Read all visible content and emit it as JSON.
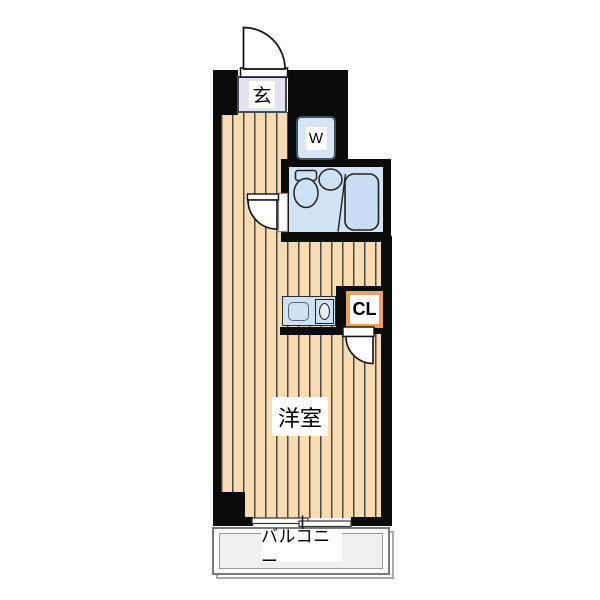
{
  "title": "apartment-floorplan",
  "labels": {
    "entrance": "玄",
    "washer": "W",
    "closet": "CL",
    "room": "洋室",
    "balcony": "バルコニー"
  },
  "colors": {
    "wall": "#0a0a0a",
    "flooring": "#f8dbb2",
    "flooring_stripe": "#4a4a42",
    "entrance_fill": "#e3e3ef",
    "fixture_fill": "#cfe1f5",
    "bathroom_fill": "#d3e3f7",
    "bathtub_fill": "#c9def5",
    "closet_accent": "#ef9f5f",
    "balcony_fill": "#f0f0ee"
  },
  "elements": [
    "entry-door-swing",
    "entrance-mat",
    "washing-machine",
    "bathroom-unit",
    "toilet",
    "washbasin",
    "bathtub",
    "bathroom-door-swing",
    "kitchen-counter",
    "kitchen-sink",
    "stove-burner",
    "closet",
    "closet-door-swing",
    "western-room-flooring",
    "sliding-window",
    "balcony"
  ]
}
